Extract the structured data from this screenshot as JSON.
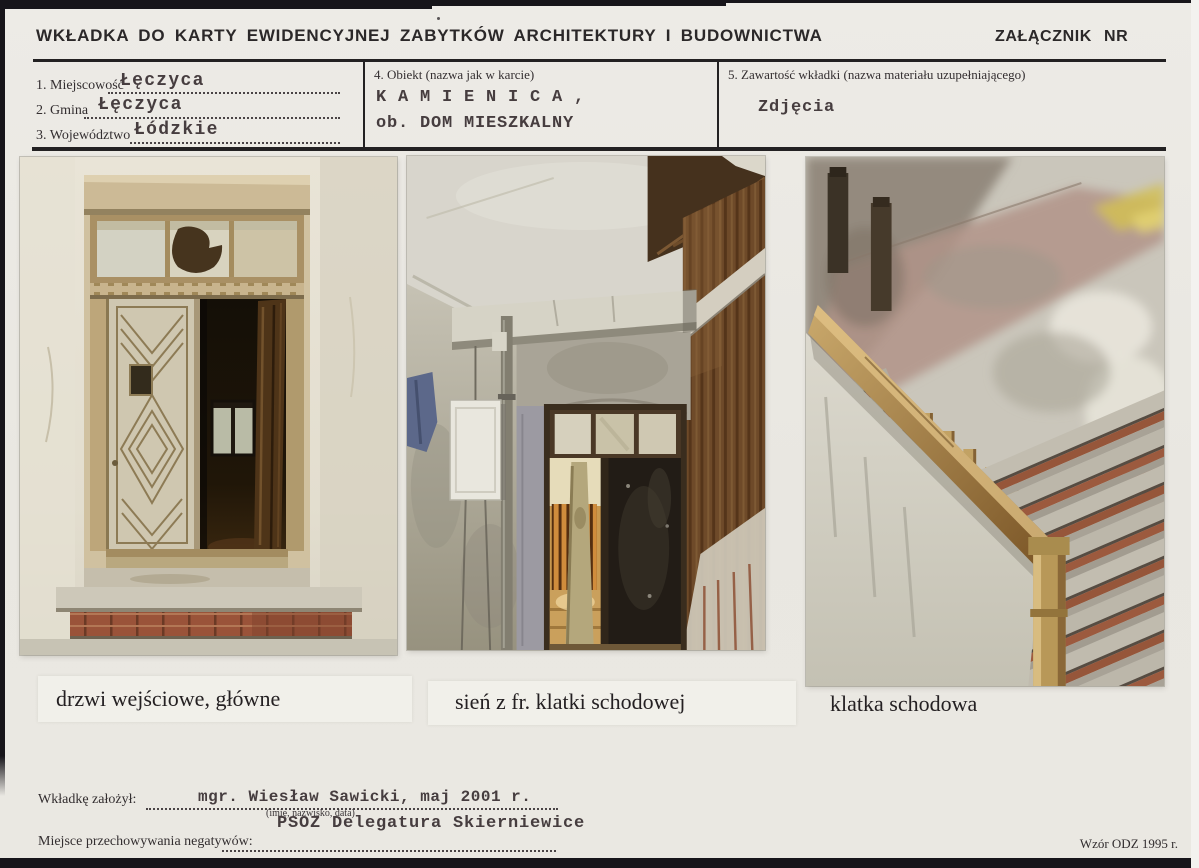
{
  "header": {
    "title": "WKŁADKA DO KARTY EWIDENCYJNEJ ZABYTKÓW ARCHITEKTURY I BUDOWNICTWA",
    "attachment_label": "ZAŁĄCZNIK NR"
  },
  "form": {
    "fields": [
      {
        "label": "1. Miejscowość",
        "value": "Łęczyca"
      },
      {
        "label": "2. Gmina",
        "value": "Łęczyca"
      },
      {
        "label": "3. Województwo",
        "value": "Łódzkie"
      },
      {
        "label": "4. Obiekt (nazwa jak w karcie)",
        "value_line1": "K A M I E N I C A ,",
        "value_line2": "ob. DOM MIESZKALNY"
      },
      {
        "label": "5. Zawartość wkładki (nazwa materiału uzupełniającego)",
        "value": "Zdjęcia"
      }
    ]
  },
  "photos": [
    {
      "caption": "drzwi wejściowe, główne"
    },
    {
      "caption": "sień z fr. klatki schodowej"
    },
    {
      "caption": "klatka schodowa"
    }
  ],
  "footer": {
    "created_by_label": "Wkładkę założył:",
    "created_by_value": "mgr. Wiesław Sawicki, maj 2001 r.",
    "created_by_note": "(imię, nazwisko, data)",
    "institution": "PSOZ Delegatura Skierniewice",
    "negatives_label": "Miejsce przechowywania negatywów:",
    "form_version": "Wzór ODZ 1995 r."
  },
  "colors": {
    "page": "#e9e7e2",
    "ink": "#232122",
    "typewriter_ink": "#453c3e"
  }
}
